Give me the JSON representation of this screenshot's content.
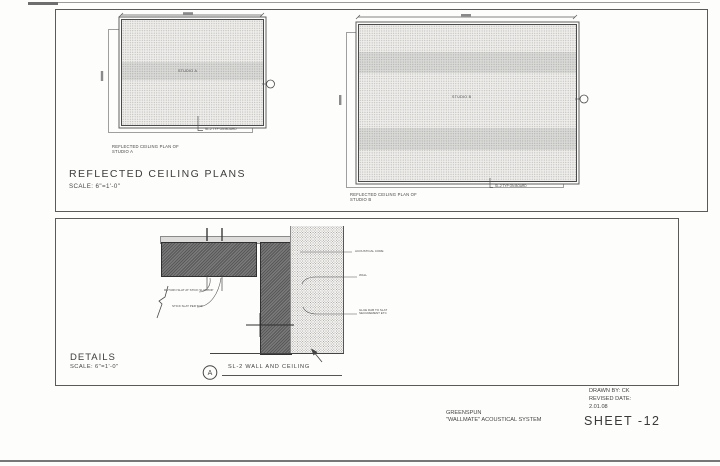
{
  "page": {
    "ceiling_section": {
      "title": "REFLECTED CEILING PLANS",
      "scale": "SCALE: 6\"=1'-0\"",
      "plan_a": {
        "room": "STUDIO A",
        "caption1": "REFLECTED CEILING PLAN OF",
        "caption2": "STUDIO A",
        "callout": "SL-2 TYP ON BOARD"
      },
      "plan_b": {
        "room": "STUDIO B",
        "caption1": "REFLECTED CEILING PLAN OF",
        "caption2": "STUDIO B",
        "callout": "SL-2 TYP ON BOARD"
      }
    },
    "details_section": {
      "title": "DETAILS",
      "scale": "SCALE: 6\"=1'-0\"",
      "detail_marker": "A",
      "detail_title": "SL-2  WALL AND CEILING",
      "label_return_slat": "RETURN SLAT AT STICK SLAT TOP",
      "label_stick_slat": "STICK SLAT PER TOP",
      "label_acoustical_core": "ACOUSTICAL CORE",
      "label_wall": "WALL",
      "label_glue1": "GLUE DAB TO SLAT",
      "label_glue2": "SECUREMENT ETC"
    },
    "title_block": {
      "drawn_by": "DRAWN BY: CK",
      "revised_label": "REVISED DATE:",
      "revised_date": "2.01.08",
      "sheet_number": "SHEET -12",
      "firm": "GREENSPUN",
      "system": "\"WALLMATE\" ACOUSTICAL SYSTEM"
    },
    "colors": {
      "ink": "#3f3f3f",
      "paper": "#fdfdfb",
      "panel_dark": "#6b6b6b"
    }
  }
}
